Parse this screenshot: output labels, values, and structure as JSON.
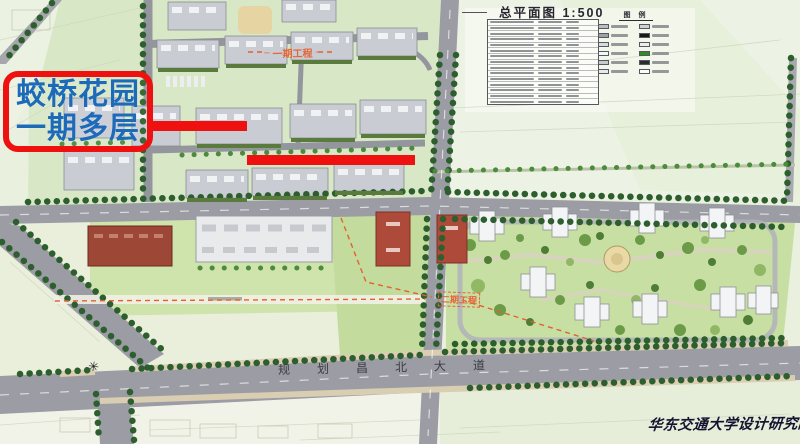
{
  "title": {
    "dash": "——",
    "text": "总平面图 1:500"
  },
  "indicator_table": {
    "row_count": 15
  },
  "legend": {
    "title": "图 例",
    "swatches": [
      "#b9bdc2",
      "#cfd2d5",
      "#9fa3a8",
      "#17181a",
      "#d8dadd",
      "#eceded",
      "#f5f6f7",
      "#2e8f1f",
      "#c7cacd",
      "#2b2c2e",
      "#e8e9ea",
      "#fbfbfb"
    ]
  },
  "callout": {
    "line1": "蛟桥花园",
    "line2": "一期多层",
    "text_color": "#1d6ab8",
    "border_color": "#ef1010"
  },
  "annotations": {
    "phase1_label": "一期工程",
    "phase1_tick": "–",
    "phase2_label": "二期工程",
    "phase_color": "#e5653a",
    "highlight_color": "#ef1010"
  },
  "roads": {
    "south_avenue": "规划昌北大道"
  },
  "markers": {
    "junction_star": "✳"
  },
  "signature": {
    "text": "华东交通大学设计研究院"
  }
}
